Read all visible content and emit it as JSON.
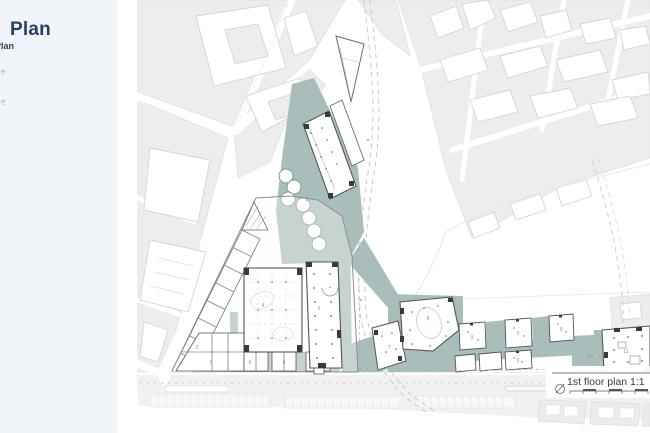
{
  "page": {
    "background": "#ffffff"
  },
  "sidebar": {
    "background": "#f1f5f9",
    "title": "Plan",
    "subtitle": "Plan",
    "notes": [
      "평면",
      "평면"
    ]
  },
  "map": {
    "caption": "1st floor plan 1:1",
    "colors": {
      "site_teal": "#a9bdbb",
      "urban_block": "#ededed",
      "building_stroke": "#d4d4d4",
      "site_wall": "#53575a",
      "wall_dark": "#3a3a3a",
      "title_navy": "#2d3e63"
    },
    "labels": [
      {
        "text": "2"
      },
      {
        "text": "3"
      },
      {
        "text": "4"
      },
      {
        "text": "5"
      },
      {
        "text": "6"
      },
      {
        "text": "6"
      },
      {
        "text": "6"
      },
      {
        "text": "7"
      },
      {
        "text": "8"
      },
      {
        "text": "9"
      },
      {
        "text": "9"
      },
      {
        "text": "9"
      },
      {
        "text": "9"
      },
      {
        "text": "10"
      },
      {
        "text": "11"
      }
    ]
  }
}
